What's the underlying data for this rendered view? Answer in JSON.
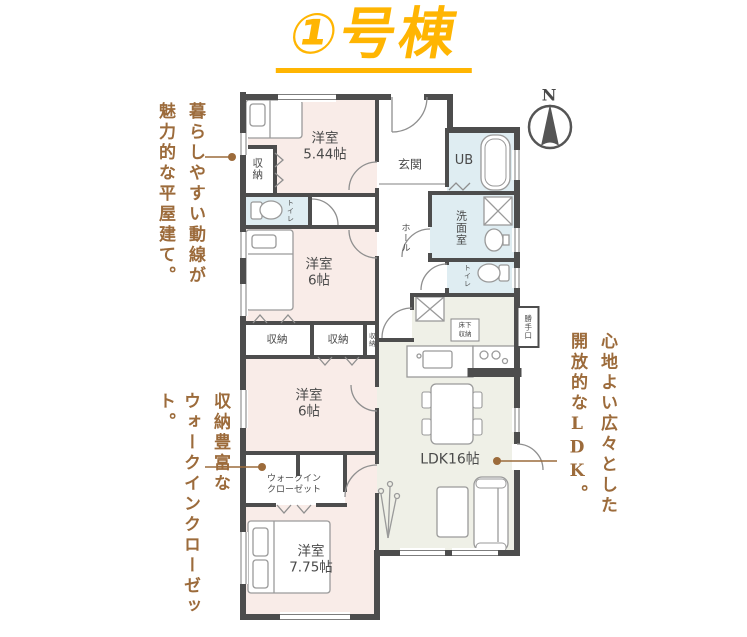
{
  "title": "①号棟",
  "compass_label": "N",
  "annotations": {
    "layout_left": [
      "暮らしやすい動線が",
      "魅力的な平屋建て。"
    ],
    "storage_left": [
      "収納豊富な",
      "ウォークインクローゼット。"
    ],
    "ldk_right": [
      "心地よい広々とした",
      "開放的なLDK。"
    ]
  },
  "rooms": {
    "bedroom_544": "洋室\n5.44帖",
    "closet_top": "収納",
    "toilet_left": "トイレ",
    "entrance": "玄関",
    "unit_bath": "UB",
    "washroom": "洗面室",
    "hall": "ホール",
    "toilet_right": "トイレ",
    "bedroom_6a": "洋室\n6帖",
    "closet_1": "収納",
    "closet_2": "収納",
    "closet_3": "収納",
    "underfloor_storage": "床下\n収納",
    "back_door": "勝手口",
    "bedroom_6b": "洋室\n6帖",
    "walk_in_closet": "ウォークイン\nクローゼット",
    "ldk": "LDK16帖",
    "bedroom_775": "洋室\n7.75帖"
  },
  "colors": {
    "accent_yellow": "#FFB502",
    "annotation_brown": "#9C6B3B",
    "room_pink": "#F9ECE8",
    "room_blue": "#DFEDF2",
    "room_green": "#EFF0E7",
    "wall": "#4D4D4D"
  }
}
